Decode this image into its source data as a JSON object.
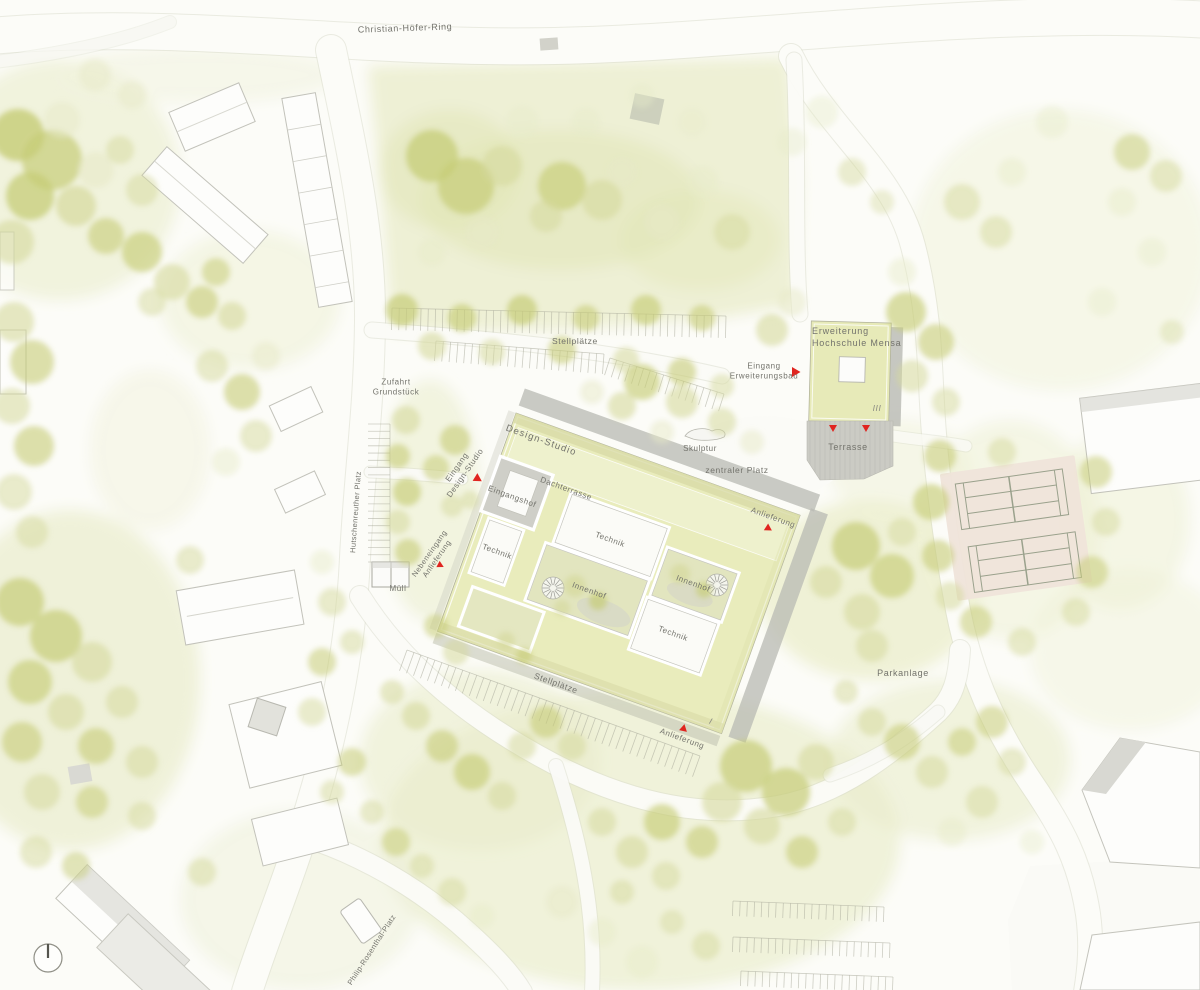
{
  "colors": {
    "paper": "#fcfcf8",
    "meadow_green": "#eceed0",
    "tree_olive": "#c6cc77",
    "roof_green": "#e9ecbc",
    "shadow_gray": "#b8b9b3",
    "court_clay": "#efe4da",
    "label_gray": "#73736c",
    "entrance_marker_red": "#e02520"
  },
  "icons": {
    "north_arrow": "circle-with-north-needle",
    "entrance_marker": "red-triangle-arrow",
    "spiral_stair": "radial-stair-glyph"
  },
  "labels": [
    {
      "id": "christian-hoefer-ring",
      "text": "Christian-Höfer-Ring"
    },
    {
      "id": "stellplaetze-nord",
      "text": "Stellplätze"
    },
    {
      "id": "zufahrt-grundstueck",
      "text": "Zufahrt\nGrundstück"
    },
    {
      "id": "erweiterung-hochschule-mensa",
      "text": "Erweiterung\nHochschule Mensa"
    },
    {
      "id": "eingang-erweiterungsbau",
      "text": "Eingang\nErweiterungsbau"
    },
    {
      "id": "geschosse-mensa",
      "text": "III"
    },
    {
      "id": "terrasse",
      "text": "Terrasse"
    },
    {
      "id": "design-studio",
      "text": "Design-Studio"
    },
    {
      "id": "dachterrasse",
      "text": "Dachterrasse"
    },
    {
      "id": "eingangshof",
      "text": "Eingangshof"
    },
    {
      "id": "eingang-design-studio",
      "text": "Eingang\nDesign-Studio"
    },
    {
      "id": "skulptur",
      "text": "Skulptur"
    },
    {
      "id": "zentraler-platz",
      "text": "zentraler Platz"
    },
    {
      "id": "anlieferung-ost",
      "text": "Anlieferung"
    },
    {
      "id": "technik-nord",
      "text": "Technik"
    },
    {
      "id": "technik-west",
      "text": "Technik"
    },
    {
      "id": "innenhof-mitte",
      "text": "Innenhof"
    },
    {
      "id": "innenhof-ost",
      "text": "Innenhof"
    },
    {
      "id": "technik-sued",
      "text": "Technik"
    },
    {
      "id": "muell",
      "text": "Müll"
    },
    {
      "id": "nebeneingang-anlieferung",
      "text": "Nebeneingang\nAnlieferung"
    },
    {
      "id": "stellplaetze-sued",
      "text": "Stellplätze"
    },
    {
      "id": "anlieferung-sued",
      "text": "Anlieferung"
    },
    {
      "id": "geschosse-studio",
      "text": "I"
    },
    {
      "id": "parkanlage",
      "text": "Parkanlage"
    },
    {
      "id": "hutschenreuther-platz",
      "text": "Hutschenreuther Platz"
    },
    {
      "id": "philip-rosenthal-platz",
      "text": "Philip-Rosenthal-Platz"
    }
  ]
}
